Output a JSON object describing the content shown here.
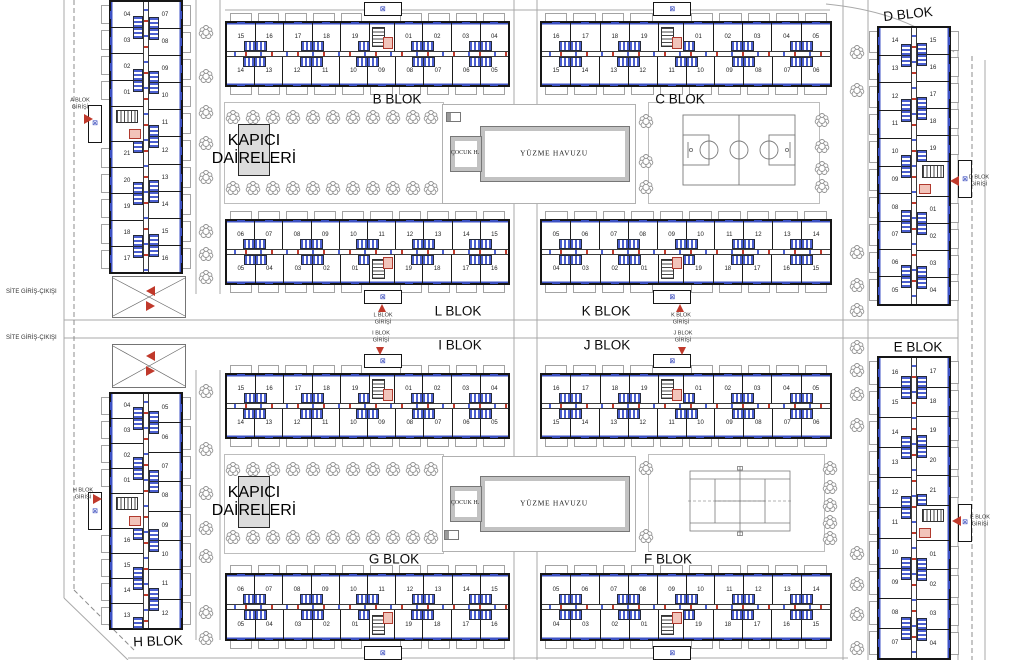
{
  "labels": {
    "site_entry_exit": "SİTE GİRİŞ-ÇIKIŞI",
    "pool": "YÜZME HAVUZU",
    "kids_pool": "ÇOCUK H.",
    "caretaker_line1": "KAPICI",
    "caretaker_line2": "DAİRELERİ"
  },
  "icons": {
    "elevator_glyph": "⊠"
  },
  "colors": {
    "wall": "#161616",
    "facade_blue": "#3d52c4",
    "accent_red": "#c0392b",
    "road_gray": "#a9a9a9",
    "tree_gray": "#8f8f8f",
    "fill_gray": "#dcdcdc"
  },
  "block_labels": [
    {
      "id": "B",
      "text": "B BLOK",
      "x": 397,
      "y": 99,
      "rot": 0
    },
    {
      "id": "C",
      "text": "C BLOK",
      "x": 680,
      "y": 99,
      "rot": 0
    },
    {
      "id": "D",
      "text": "D BLOK",
      "x": 908,
      "y": 14,
      "rot": -6
    },
    {
      "id": "L",
      "text": "L BLOK",
      "x": 458,
      "y": 311,
      "rot": 0
    },
    {
      "id": "K",
      "text": "K BLOK",
      "x": 606,
      "y": 311,
      "rot": 0
    },
    {
      "id": "I",
      "text": "I BLOK",
      "x": 460,
      "y": 345,
      "rot": 0
    },
    {
      "id": "J",
      "text": "J BLOK",
      "x": 607,
      "y": 345,
      "rot": 0
    },
    {
      "id": "E",
      "text": "E BLOK",
      "x": 918,
      "y": 347,
      "rot": 0
    },
    {
      "id": "G",
      "text": "G BLOK",
      "x": 394,
      "y": 559,
      "rot": 0
    },
    {
      "id": "F",
      "text": "F BLOK",
      "x": 668,
      "y": 559,
      "rot": 0
    },
    {
      "id": "H",
      "text": "H BLOK",
      "x": 158,
      "y": 641,
      "rot": -2
    }
  ],
  "entrances": [
    {
      "id": "A",
      "line1": "A BLOK",
      "line2": "GİRİŞİ",
      "x": 80,
      "y": 104,
      "dir": "right",
      "ax": 84,
      "ay": 114
    },
    {
      "id": "H",
      "line1": "H BLOK",
      "line2": "GİRİŞİ",
      "x": 83,
      "y": 494,
      "dir": "right",
      "ax": 93,
      "ay": 494
    },
    {
      "id": "D",
      "line1": "D BLOK",
      "line2": "GİRİŞİ",
      "x": 979,
      "y": 181,
      "dir": "left",
      "ax": 950,
      "ay": 176
    },
    {
      "id": "E",
      "line1": "E BLOK",
      "line2": "GİRİŞİ",
      "x": 980,
      "y": 521,
      "dir": "left",
      "ax": 952,
      "ay": 516
    },
    {
      "id": "L",
      "line1": "L BLOK",
      "line2": "GİRİŞİ",
      "x": 383,
      "y": 319,
      "dir": "up",
      "ax": 378,
      "ay": 304
    },
    {
      "id": "K",
      "line1": "K BLOK",
      "line2": "GİRİŞİ",
      "x": 681,
      "y": 319,
      "dir": "up",
      "ax": 676,
      "ay": 304
    },
    {
      "id": "I",
      "line1": "I BLOK",
      "line2": "GİRİŞİ",
      "x": 381,
      "y": 337,
      "dir": "down",
      "ax": 376,
      "ay": 347
    },
    {
      "id": "J",
      "line1": "J BLOK",
      "line2": "GİRİŞİ",
      "x": 683,
      "y": 337,
      "dir": "down",
      "ax": 678,
      "ay": 347
    }
  ],
  "site_entries": [
    {
      "x": 6,
      "y": 292,
      "ax": 146,
      "ay_left": 286,
      "ay_right": 301
    },
    {
      "x": 6,
      "y": 338,
      "ax": 146,
      "ay_left": 351,
      "ay_right": 366
    }
  ],
  "h_blocks": [
    {
      "id": "B",
      "x": 225,
      "y": 12,
      "w": 285,
      "h": 84,
      "bump": "up",
      "top": [
        "15",
        "16",
        "17",
        "18",
        "19",
        "C",
        "01",
        "02",
        "03",
        "04"
      ],
      "bottom": [
        "14",
        "13",
        "12",
        "11",
        "10",
        "09",
        "08",
        "07",
        "06",
        "05"
      ]
    },
    {
      "id": "C",
      "x": 540,
      "y": 12,
      "w": 292,
      "h": 84,
      "bump": "up",
      "top": [
        "16",
        "17",
        "18",
        "19",
        "C",
        "01",
        "02",
        "03",
        "04",
        "05"
      ],
      "bottom": [
        "15",
        "14",
        "13",
        "12",
        "11",
        "10",
        "09",
        "08",
        "07",
        "06"
      ]
    },
    {
      "id": "L",
      "x": 225,
      "y": 210,
      "w": 285,
      "h": 84,
      "bump": "dn",
      "top": [
        "06",
        "07",
        "08",
        "09",
        "10",
        "11",
        "12",
        "13",
        "14",
        "15"
      ],
      "bottom": [
        "05",
        "04",
        "03",
        "02",
        "01",
        "C",
        "19",
        "18",
        "17",
        "16"
      ]
    },
    {
      "id": "K",
      "x": 540,
      "y": 210,
      "w": 292,
      "h": 84,
      "bump": "dn",
      "top": [
        "05",
        "06",
        "07",
        "08",
        "09",
        "10",
        "11",
        "12",
        "13",
        "14"
      ],
      "bottom": [
        "04",
        "03",
        "02",
        "01",
        "C",
        "19",
        "18",
        "17",
        "16",
        "15"
      ]
    },
    {
      "id": "I",
      "x": 225,
      "y": 364,
      "w": 285,
      "h": 84,
      "bump": "up",
      "top": [
        "15",
        "16",
        "17",
        "18",
        "19",
        "C",
        "01",
        "02",
        "03",
        "04"
      ],
      "bottom": [
        "14",
        "13",
        "12",
        "11",
        "10",
        "09",
        "08",
        "07",
        "06",
        "05"
      ]
    },
    {
      "id": "J",
      "x": 540,
      "y": 364,
      "w": 292,
      "h": 84,
      "bump": "up",
      "top": [
        "16",
        "17",
        "18",
        "19",
        "C",
        "01",
        "02",
        "03",
        "04",
        "05"
      ],
      "bottom": [
        "15",
        "14",
        "13",
        "12",
        "11",
        "10",
        "09",
        "08",
        "07",
        "06"
      ]
    },
    {
      "id": "G",
      "x": 225,
      "y": 564,
      "w": 285,
      "h": 86,
      "bump": "dn",
      "top": [
        "06",
        "07",
        "08",
        "09",
        "10",
        "11",
        "12",
        "13",
        "14",
        "15"
      ],
      "bottom": [
        "05",
        "04",
        "03",
        "02",
        "01",
        "C",
        "19",
        "18",
        "17",
        "16"
      ]
    },
    {
      "id": "F",
      "x": 540,
      "y": 564,
      "w": 292,
      "h": 86,
      "bump": "dn",
      "top": [
        "05",
        "06",
        "07",
        "08",
        "09",
        "10",
        "11",
        "12",
        "13",
        "14"
      ],
      "bottom": [
        "04",
        "03",
        "02",
        "01",
        "C",
        "19",
        "18",
        "17",
        "16",
        "15"
      ]
    }
  ],
  "v_blocks": [
    {
      "id": "A",
      "x": 100,
      "y": 0,
      "w": 92,
      "h": 274,
      "bump": "left",
      "left": [
        "04",
        "03",
        "02",
        "01",
        "C",
        "21",
        "20",
        "19",
        "18",
        "17"
      ],
      "right": [
        "07",
        "08",
        "09",
        "10",
        "11",
        "12",
        "13",
        "14",
        "15",
        "16"
      ]
    },
    {
      "id": "H",
      "x": 100,
      "y": 392,
      "w": 92,
      "h": 238,
      "bump": "left",
      "left": [
        "04",
        "03",
        "02",
        "01",
        "C",
        "16",
        "15",
        "14",
        "13"
      ],
      "right": [
        "05",
        "06",
        "07",
        "08",
        "09",
        "10",
        "11",
        "12"
      ]
    },
    {
      "id": "D",
      "x": 868,
      "y": 26,
      "w": 92,
      "h": 280,
      "bump": "right",
      "left": [
        "14",
        "13",
        "12",
        "11",
        "10",
        "09",
        "08",
        "07",
        "06",
        "05"
      ],
      "right": [
        "15",
        "16",
        "17",
        "18",
        "19",
        "C",
        "01",
        "02",
        "03",
        "04"
      ]
    },
    {
      "id": "E",
      "x": 868,
      "y": 356,
      "w": 92,
      "h": 304,
      "bump": "right",
      "left": [
        "16",
        "15",
        "14",
        "13",
        "12",
        "11",
        "10",
        "09",
        "08",
        "07"
      ],
      "right": [
        "17",
        "18",
        "19",
        "20",
        "21",
        "C",
        "01",
        "02",
        "03",
        "04"
      ]
    }
  ],
  "amenities": {
    "pools": [
      {
        "zone": {
          "x": 442,
          "y": 104,
          "w": 192,
          "h": 98
        },
        "pool": {
          "x": 480,
          "y": 126,
          "w": 148,
          "h": 54
        },
        "kids": {
          "x": 450,
          "y": 136,
          "w": 30,
          "h": 34
        },
        "eq": {
          "x": 446,
          "y": 112
        }
      },
      {
        "zone": {
          "x": 442,
          "y": 456,
          "w": 192,
          "h": 94
        },
        "pool": {
          "x": 480,
          "y": 476,
          "w": 148,
          "h": 54
        },
        "kids": {
          "x": 450,
          "y": 486,
          "w": 30,
          "h": 34
        },
        "eq": {
          "x": 444,
          "y": 530
        }
      }
    ],
    "caretakers": [
      {
        "x": 238,
        "y": 124,
        "w": 30,
        "h": 50
      },
      {
        "x": 238,
        "y": 476,
        "w": 30,
        "h": 50
      }
    ],
    "garden_zones": [
      {
        "x": 224,
        "y": 102,
        "w": 218,
        "h": 100
      },
      {
        "x": 648,
        "y": 102,
        "w": 170,
        "h": 100
      },
      {
        "x": 224,
        "y": 454,
        "w": 218,
        "h": 98
      },
      {
        "x": 648,
        "y": 454,
        "w": 175,
        "h": 96
      }
    ],
    "basketball": {
      "x": 682,
      "y": 114,
      "w": 114,
      "h": 72
    },
    "tennis": {
      "x": 688,
      "y": 466,
      "w": 104,
      "h": 70
    },
    "ramps": [
      {
        "x": 112,
        "y": 276,
        "w": 74,
        "h": 42
      },
      {
        "x": 112,
        "y": 344,
        "w": 74,
        "h": 44
      }
    ]
  },
  "roads": {
    "lines": [
      [
        64,
        0,
        64,
        598
      ],
      [
        514,
        0,
        514,
        660
      ],
      [
        537,
        0,
        537,
        660
      ],
      [
        843,
        0,
        843,
        660
      ],
      [
        868,
        0,
        868,
        660
      ],
      [
        958,
        46,
        958,
        660
      ],
      [
        985,
        60,
        985,
        660
      ],
      [
        64,
        320,
        958,
        320
      ],
      [
        64,
        338,
        958,
        338
      ],
      [
        64,
        598,
        128,
        660
      ],
      [
        128,
        658,
        848,
        658
      ],
      [
        225,
        10,
        830,
        10
      ],
      [
        196,
        0,
        196,
        294
      ],
      [
        220,
        0,
        220,
        294
      ],
      [
        196,
        370,
        196,
        640
      ],
      [
        220,
        370,
        220,
        640
      ]
    ],
    "dashed": [
      [
        74,
        0,
        74,
        590
      ],
      [
        972,
        56,
        972,
        660
      ],
      [
        74,
        590,
        134,
        650
      ]
    ],
    "paths": [
      "M826,4 Q908,12 954,52"
    ]
  },
  "trees": [
    [
      206,
      32
    ],
    [
      206,
      76
    ],
    [
      206,
      112
    ],
    [
      206,
      143
    ],
    [
      206,
      177
    ],
    [
      206,
      231
    ],
    [
      206,
      254
    ],
    [
      206,
      277
    ],
    [
      206,
      391
    ],
    [
      206,
      449
    ],
    [
      206,
      493
    ],
    [
      206,
      528
    ],
    [
      206,
      556
    ],
    [
      206,
      612
    ],
    [
      206,
      638
    ],
    [
      233,
      117
    ],
    [
      253,
      117
    ],
    [
      273,
      117
    ],
    [
      293,
      117
    ],
    [
      313,
      117
    ],
    [
      333,
      117
    ],
    [
      353,
      117
    ],
    [
      373,
      117
    ],
    [
      393,
      117
    ],
    [
      413,
      117
    ],
    [
      431,
      117
    ],
    [
      233,
      188
    ],
    [
      253,
      188
    ],
    [
      273,
      188
    ],
    [
      293,
      188
    ],
    [
      313,
      188
    ],
    [
      333,
      188
    ],
    [
      353,
      188
    ],
    [
      373,
      188
    ],
    [
      393,
      188
    ],
    [
      413,
      188
    ],
    [
      431,
      188
    ],
    [
      233,
      469
    ],
    [
      253,
      469
    ],
    [
      273,
      469
    ],
    [
      293,
      469
    ],
    [
      313,
      469
    ],
    [
      333,
      469
    ],
    [
      353,
      469
    ],
    [
      373,
      469
    ],
    [
      393,
      469
    ],
    [
      413,
      469
    ],
    [
      431,
      469
    ],
    [
      233,
      537
    ],
    [
      253,
      537
    ],
    [
      273,
      537
    ],
    [
      293,
      537
    ],
    [
      313,
      537
    ],
    [
      333,
      537
    ],
    [
      353,
      537
    ],
    [
      373,
      537
    ],
    [
      393,
      537
    ],
    [
      413,
      537
    ],
    [
      431,
      537
    ],
    [
      646,
      121
    ],
    [
      646,
      161
    ],
    [
      646,
      187
    ],
    [
      646,
      468
    ],
    [
      646,
      536
    ],
    [
      822,
      120
    ],
    [
      822,
      146
    ],
    [
      822,
      168
    ],
    [
      822,
      186
    ],
    [
      830,
      468
    ],
    [
      830,
      487
    ],
    [
      830,
      505
    ],
    [
      830,
      522
    ],
    [
      830,
      538
    ],
    [
      857,
      52
    ],
    [
      857,
      90
    ],
    [
      857,
      252
    ],
    [
      857,
      285
    ],
    [
      857,
      310
    ],
    [
      857,
      347
    ],
    [
      857,
      370
    ],
    [
      857,
      394
    ],
    [
      857,
      425
    ],
    [
      857,
      553
    ],
    [
      857,
      584
    ],
    [
      857,
      614
    ],
    [
      857,
      648
    ]
  ]
}
